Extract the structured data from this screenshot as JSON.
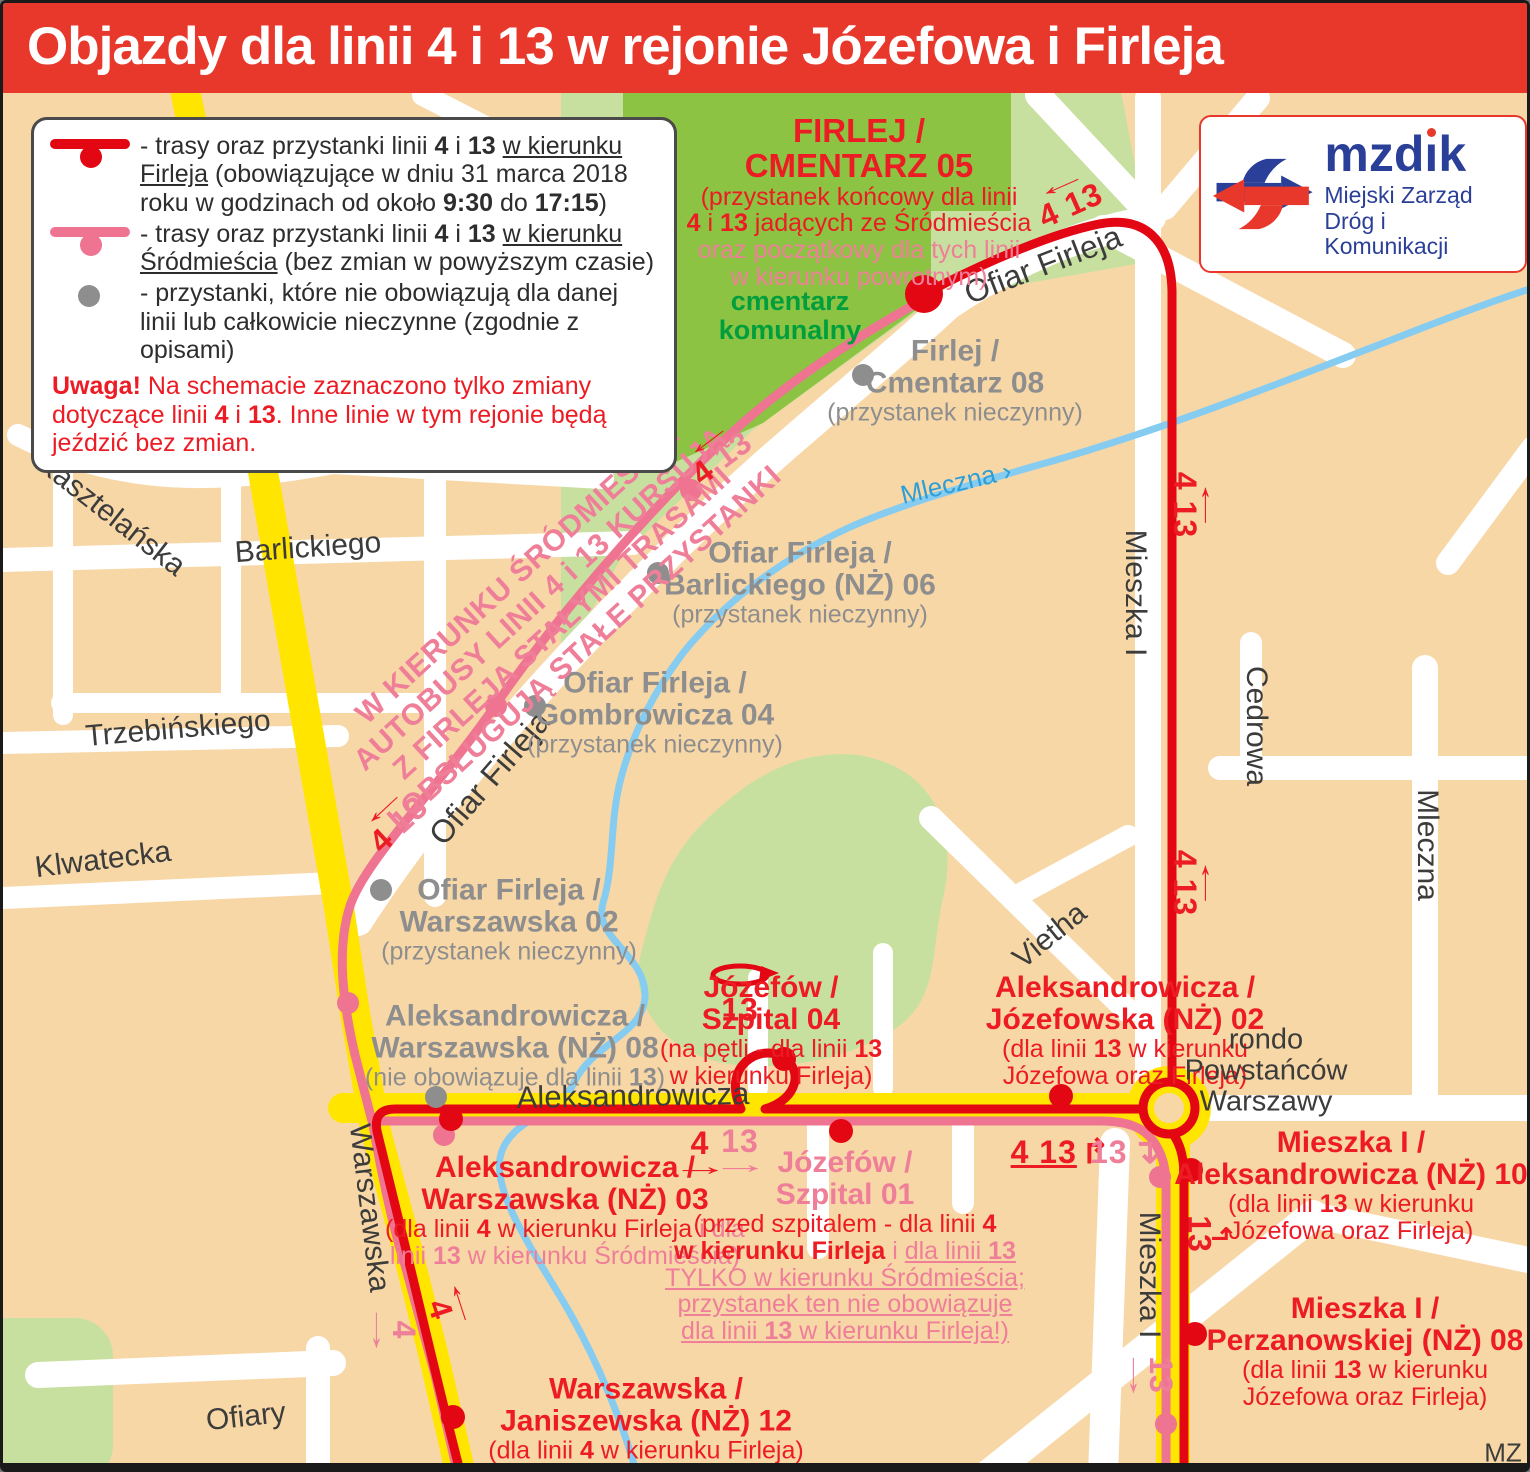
{
  "header": {
    "title": "Objazdy dla linii 4 i 13 w rejonie Józefowa i Firleja"
  },
  "logo": {
    "name": "mzdik",
    "sub1": "Miejski Zarząd",
    "sub2": "Dróg i Komunikacji"
  },
  "colors": {
    "header_bg": "#e8382b",
    "route_red": "#e30613",
    "route_pink": "#ee7491",
    "text_red": "#ec1b24",
    "text_pink": "#ef7e99",
    "gray": "#8e8e8e",
    "dark": "#3c3c3b",
    "green_text": "#009e3d",
    "river_blue": "#86ccf1",
    "yellow_road": "#ffe500",
    "park": "#c8e09f",
    "park_dark": "#8cc342",
    "background": "#f8d7a7",
    "logo_blue": "#2a3f97"
  },
  "legend": {
    "items": [
      {
        "icon": "line-red",
        "segs": [
          {
            "t": "- trasy oraz przystanki linii "
          },
          {
            "t": "4",
            "b": 1
          },
          {
            "t": " i "
          },
          {
            "t": "13",
            "b": 1
          },
          {
            "t": " "
          },
          {
            "t": "w kierunku Firleja",
            "u": 1
          },
          {
            "t": " (obowiązujące w dniu 31 marca 2018 roku w godzinach od około "
          },
          {
            "t": "9:30",
            "b": 1
          },
          {
            "t": " do "
          },
          {
            "t": "17:15",
            "b": 1
          },
          {
            "t": ")"
          }
        ]
      },
      {
        "icon": "line-pink",
        "segs": [
          {
            "t": "- trasy oraz przystanki linii "
          },
          {
            "t": "4",
            "b": 1
          },
          {
            "t": " i "
          },
          {
            "t": "13",
            "b": 1
          },
          {
            "t": " "
          },
          {
            "t": "w kierunku Śródmieścia",
            "u": 1
          },
          {
            "t": " (bez zmian w powyższym czasie)"
          }
        ]
      },
      {
        "icon": "dot-gray",
        "segs": [
          {
            "t": "- przystanki, które nie obowiązują dla danej linii lub całkowicie nieczynne (zgodnie z opisami)"
          }
        ]
      }
    ],
    "note": [
      {
        "t": "Uwaga!",
        "b": 1
      },
      {
        "t": " Na schemacie zaznaczono tylko zmiany dotyczące linii "
      },
      {
        "t": "4",
        "b": 1
      },
      {
        "t": " i "
      },
      {
        "t": "13",
        "b": 1
      },
      {
        "t": ". Inne linie w tym rejonie będą jeździć bez zmian."
      }
    ]
  },
  "map": {
    "street_labels": [
      {
        "t": "Kasztelańska",
        "x": 108,
        "y": 512,
        "rot": 38,
        "fs": 30
      },
      {
        "t": "Barlickiego",
        "x": 305,
        "y": 545,
        "rot": -4,
        "fs": 30
      },
      {
        "t": "Trzebińskiego",
        "x": 175,
        "y": 726,
        "rot": -5,
        "fs": 30
      },
      {
        "t": "Klwatecka",
        "x": 100,
        "y": 857,
        "rot": -7,
        "fs": 30
      },
      {
        "t": "Ofiar Firleja",
        "x": 1040,
        "y": 262,
        "rot": -21,
        "fs": 32
      },
      {
        "t": "Ofiar Firleja",
        "x": 487,
        "y": 775,
        "rot": -49,
        "fs": 32
      },
      {
        "t": "Mieszka I",
        "x": 1132,
        "y": 590,
        "rot": 90,
        "fs": 30
      },
      {
        "t": "Cedrowa",
        "x": 1253,
        "y": 723,
        "rot": 90,
        "fs": 30
      },
      {
        "t": "Mleczna",
        "x": 1424,
        "y": 842,
        "rot": 90,
        "fs": 30
      },
      {
        "t": "Vietha",
        "x": 1047,
        "y": 933,
        "rot": -39,
        "fs": 30
      },
      {
        "t": "Aleksandrowicza",
        "x": 630,
        "y": 1093,
        "rot": -1,
        "fs": 31
      },
      {
        "t": "Warszawska",
        "x": 366,
        "y": 1205,
        "rot": 83,
        "fs": 30
      },
      {
        "t": "Mieszka I",
        "x": 1146,
        "y": 1272,
        "rot": 90,
        "fs": 30
      },
      {
        "t": "Ofiary",
        "x": 243,
        "y": 1414,
        "rot": -6,
        "fs": 30
      },
      {
        "t": "Mleczna ›",
        "x": 953,
        "y": 480,
        "rot": -13,
        "fs": 26,
        "c": "blue"
      },
      {
        "t": "MZ",
        "x": 1500,
        "y": 1450,
        "rot": 0,
        "fs": 26,
        "c": "dark"
      }
    ],
    "stop_labels": [
      {
        "x": 856,
        "y": 199,
        "lines": [
          {
            "t": "FIRLEJ /",
            "cls": "hr",
            "fs": 33
          },
          {
            "t": "CMENTARZ 05",
            "cls": "hr",
            "fs": 33
          },
          {
            "t": "(przystanek końcowy dla linii",
            "cls": "dr"
          },
          {
            "segs": [
              {
                "t": "4",
                "b": 1
              },
              {
                "t": " i "
              },
              {
                "t": "13",
                "b": 1
              },
              {
                "t": " jadących ze Śródmieścia"
              }
            ],
            "cls": "dr"
          },
          {
            "t": "oraz początkowy dla tych linii",
            "cls": "dp"
          },
          {
            "t": "w kierunku powrotnym)",
            "cls": "dp"
          }
        ]
      },
      {
        "x": 787,
        "y": 313,
        "lines": [
          {
            "t": "cmentarz",
            "cls": "hgrn"
          },
          {
            "t": "komunalny",
            "cls": "hgrn"
          }
        ]
      },
      {
        "x": 952,
        "y": 378,
        "lines": [
          {
            "t": "Firlej /",
            "cls": "hg"
          },
          {
            "t": "Cmentarz 08",
            "cls": "hg"
          },
          {
            "t": "(przystanek nieczynny)",
            "cls": "dg"
          }
        ]
      },
      {
        "x": 797,
        "y": 580,
        "lines": [
          {
            "t": "Ofiar Firleja /",
            "cls": "hg"
          },
          {
            "t": "Barlickiego (NŻ) 06",
            "cls": "hg"
          },
          {
            "t": "(przystanek nieczynny)",
            "cls": "dg"
          }
        ]
      },
      {
        "x": 652,
        "y": 710,
        "lines": [
          {
            "t": "Ofiar Firleja /",
            "cls": "hg"
          },
          {
            "t": "Gombrowicza 04",
            "cls": "hg"
          },
          {
            "t": "(przystanek nieczynny)",
            "cls": "dg"
          }
        ]
      },
      {
        "x": 506,
        "y": 917,
        "lines": [
          {
            "t": "Ofiar Firleja /",
            "cls": "hg"
          },
          {
            "t": "Warszawska 02",
            "cls": "hg"
          },
          {
            "t": "(przystanek nieczynny)",
            "cls": "dg"
          }
        ]
      },
      {
        "x": 512,
        "y": 1043,
        "lines": [
          {
            "t": "Aleksandrowicza /",
            "cls": "hg"
          },
          {
            "t": "Warszawska (NŻ) 08",
            "cls": "hg"
          },
          {
            "segs": [
              {
                "t": "(nie obowiązuje dla linii "
              },
              {
                "t": "13",
                "b": 1
              },
              {
                "t": ")"
              }
            ],
            "cls": "dg"
          }
        ]
      },
      {
        "x": 768,
        "y": 1028,
        "lines": [
          {
            "t": "Józefów /",
            "cls": "hr"
          },
          {
            "t": "Szpital 04",
            "cls": "hr"
          },
          {
            "segs": [
              {
                "t": "(na pętli - dla linii "
              },
              {
                "t": "13",
                "b": 1
              }
            ],
            "cls": "dr"
          },
          {
            "t": "w kierunku Firleja)",
            "cls": "dr"
          }
        ]
      },
      {
        "x": 1122,
        "y": 1028,
        "lines": [
          {
            "t": "Aleksandrowicza /",
            "cls": "hr"
          },
          {
            "t": "Józefowska (NŻ) 02",
            "cls": "hr"
          },
          {
            "segs": [
              {
                "t": "(dla linii "
              },
              {
                "t": "13",
                "b": 1
              },
              {
                "t": " w kierunku"
              }
            ],
            "cls": "dr"
          },
          {
            "t": "Józefowa oraz Firleja)",
            "cls": "dr"
          }
        ]
      },
      {
        "x": 562,
        "y": 1208,
        "lines": [
          {
            "t": "Aleksandrowicza /",
            "cls": "hr"
          },
          {
            "t": "Warszawska (NŻ) 03",
            "cls": "hr"
          },
          {
            "segs": [
              {
                "t": "(dla linii "
              },
              {
                "t": "4",
                "b": 1
              },
              {
                "t": " w kierunku Firleja "
              },
              {
                "t": "i dla",
                "c": "pink"
              }
            ],
            "cls": "dr"
          },
          {
            "segs": [
              {
                "t": "linii "
              },
              {
                "t": "13",
                "b": 1
              },
              {
                "t": " w kierunku Śródmieścia)"
              }
            ],
            "cls": "dp"
          }
        ]
      },
      {
        "x": 842,
        "y": 1243,
        "lines": [
          {
            "t": "Józefów /",
            "cls": "hp"
          },
          {
            "t": "Szpital 01",
            "cls": "hp"
          },
          {
            "segs": [
              {
                "t": "(przed szpitalem - dla linii "
              },
              {
                "t": "4",
                "b": 1
              }
            ],
            "cls": "dr"
          },
          {
            "segs": [
              {
                "t": "w kierunku Firleja",
                "b": 1
              },
              {
                "t": " i ",
                "c": "pink"
              },
              {
                "t": "dla linii ",
                "c": "pink",
                "u": 1
              },
              {
                "t": "13",
                "c": "pink",
                "b": 1,
                "u": 1
              }
            ],
            "cls": "dr"
          },
          {
            "segs": [
              {
                "t": "TYLKO w kierunku Śródmieścia;",
                "u": 1
              }
            ],
            "cls": "dp"
          },
          {
            "segs": [
              {
                "t": "przystanek ten nie obowiązuje",
                "u": 1
              }
            ],
            "cls": "dp"
          },
          {
            "segs": [
              {
                "t": "dla linii ",
                "u": 1
              },
              {
                "t": "13",
                "b": 1,
                "u": 1
              },
              {
                "t": " w kierunku Firleja!)",
                "u": 1
              }
            ],
            "cls": "dp"
          }
        ]
      },
      {
        "x": 1348,
        "y": 1183,
        "lines": [
          {
            "t": "Mieszka I /",
            "cls": "hr"
          },
          {
            "t": "Aleksandrowicza (NŻ) 10",
            "cls": "hr"
          },
          {
            "segs": [
              {
                "t": "(dla linii "
              },
              {
                "t": "13",
                "b": 1
              },
              {
                "t": " w kierunku"
              }
            ],
            "cls": "dr"
          },
          {
            "t": "Józefowa oraz Firleja)",
            "cls": "dr"
          }
        ]
      },
      {
        "x": 1362,
        "y": 1349,
        "lines": [
          {
            "t": "Mieszka I /",
            "cls": "hr"
          },
          {
            "t": "Perzanowskiej (NŻ) 08",
            "cls": "hr"
          },
          {
            "segs": [
              {
                "t": "(dla linii "
              },
              {
                "t": "13",
                "b": 1
              },
              {
                "t": " w kierunku"
              }
            ],
            "cls": "dr"
          },
          {
            "t": "Józefowa oraz Firleja)",
            "cls": "dr"
          }
        ]
      },
      {
        "x": 643,
        "y": 1416,
        "lines": [
          {
            "t": "Warszawska /",
            "cls": "hr"
          },
          {
            "t": "Janiszewska (NŻ) 12",
            "cls": "hr"
          },
          {
            "segs": [
              {
                "t": "(dla linii "
              },
              {
                "t": "4",
                "b": 1
              },
              {
                "t": " w kierunku Firleja)"
              }
            ],
            "cls": "dr"
          }
        ]
      },
      {
        "x": 1263,
        "y": 1068,
        "lines": [
          {
            "t": "rondo",
            "cls": "pl"
          },
          {
            "t": "Powstańców",
            "cls": "pl"
          },
          {
            "t": "Warszawy",
            "cls": "pl"
          }
        ]
      },
      {
        "x": 548,
        "y": 608,
        "rot": -42.5,
        "lines": [
          {
            "t": "W KIERUNKU ŚRÓDMIEŚCIA",
            "cls": "kr"
          },
          {
            "t": "AUTOBUSY LINII 4 i 13 KURSUJĄ",
            "cls": "kr"
          },
          {
            "t": "Z FIRLEJA STAŁYMI TRASAMI",
            "cls": "kr"
          },
          {
            "t": "I OBSŁUGUJĄ STAŁE PRZYSTANKI",
            "cls": "kr"
          }
        ]
      }
    ],
    "markers": [
      {
        "x": 1063,
        "y": 192,
        "rot": -24,
        "c": "red",
        "t": "4 13",
        "arrow": "←",
        "ap": "a"
      },
      {
        "x": 712,
        "y": 446,
        "rot": -37,
        "c": "red",
        "parts": [
          {
            "t": "4 ",
            "c": "red"
          },
          {
            "t": "13",
            "c": "pink"
          }
        ],
        "arrow": "←",
        "ap": "a"
      },
      {
        "x": 388,
        "y": 813,
        "rot": -43,
        "c": "red",
        "parts": [
          {
            "t": "4 ",
            "c": "red"
          },
          {
            "t": "13",
            "c": "pink"
          }
        ],
        "arrow": "←",
        "ap": "a"
      },
      {
        "x": 1193,
        "y": 502,
        "rot": 90,
        "c": "red",
        "t": "4 13",
        "arrow": "←",
        "ap": "a"
      },
      {
        "x": 1193,
        "y": 880,
        "rot": 90,
        "c": "red",
        "t": "4 13",
        "arrow": "←",
        "ap": "a"
      },
      {
        "x": 697,
        "y": 1152,
        "rot": 0,
        "c": "red",
        "t": "4",
        "arrow": "→",
        "ap": "b"
      },
      {
        "x": 737,
        "y": 1150,
        "rot": 0,
        "c": "pink",
        "t": "13",
        "arrow": "→",
        "ap": "b"
      },
      {
        "x": 1057,
        "y": 1149,
        "rot": 0,
        "c": "red",
        "t": "4 13",
        "u": 1,
        "arrow": "↱",
        "ap": "r"
      },
      {
        "x": 1122,
        "y": 1149,
        "rot": 0,
        "c": "pink",
        "t": "13",
        "arrow": "↴",
        "ap": "r"
      },
      {
        "x": 1206,
        "y": 1231,
        "rot": 90,
        "c": "red",
        "t": "13",
        "arrow": "↰",
        "ap": "a"
      },
      {
        "x": 1146,
        "y": 1372,
        "rot": 90,
        "c": "pink",
        "t": "13",
        "arrow": "→",
        "ap": "b"
      },
      {
        "x": 389,
        "y": 1327,
        "rot": 90,
        "c": "pink",
        "t": "4",
        "arrow": "→",
        "ap": "b"
      },
      {
        "x": 448,
        "y": 1303,
        "rot": 72,
        "c": "red",
        "t": "4",
        "arrow": "←",
        "ap": "a"
      },
      {
        "x": 737,
        "y": 1007,
        "rot": 0,
        "c": "red",
        "t": "13"
      }
    ]
  }
}
